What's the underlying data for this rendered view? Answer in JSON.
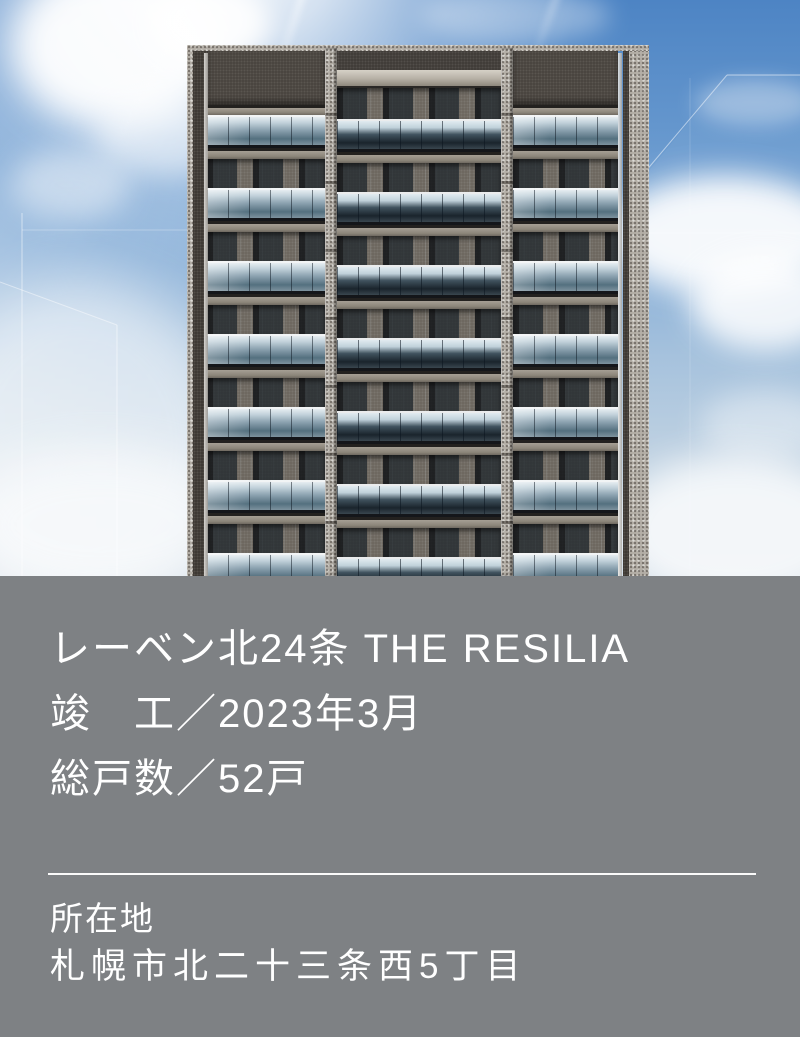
{
  "hero": {
    "building": {
      "visible_balcony_rows": 7,
      "bays": 3
    }
  },
  "info_panel": {
    "title": "レーベン北24条 THE RESILIA",
    "completion": "竣　工／2023年3月",
    "total_units": "総戸数／52戸",
    "location_label": "所在地",
    "address": "札幌市北二十三条西5丁目"
  },
  "colors": {
    "panel_bg": "#7e8184",
    "text": "#ffffff",
    "divider": "#ffffff",
    "sky_top": "#4d84c4",
    "sky_bottom": "#c9d7e3",
    "concrete_dark": "#46413c",
    "concrete_light": "#b4afa7",
    "balcony_glass": "#8da3b1"
  }
}
